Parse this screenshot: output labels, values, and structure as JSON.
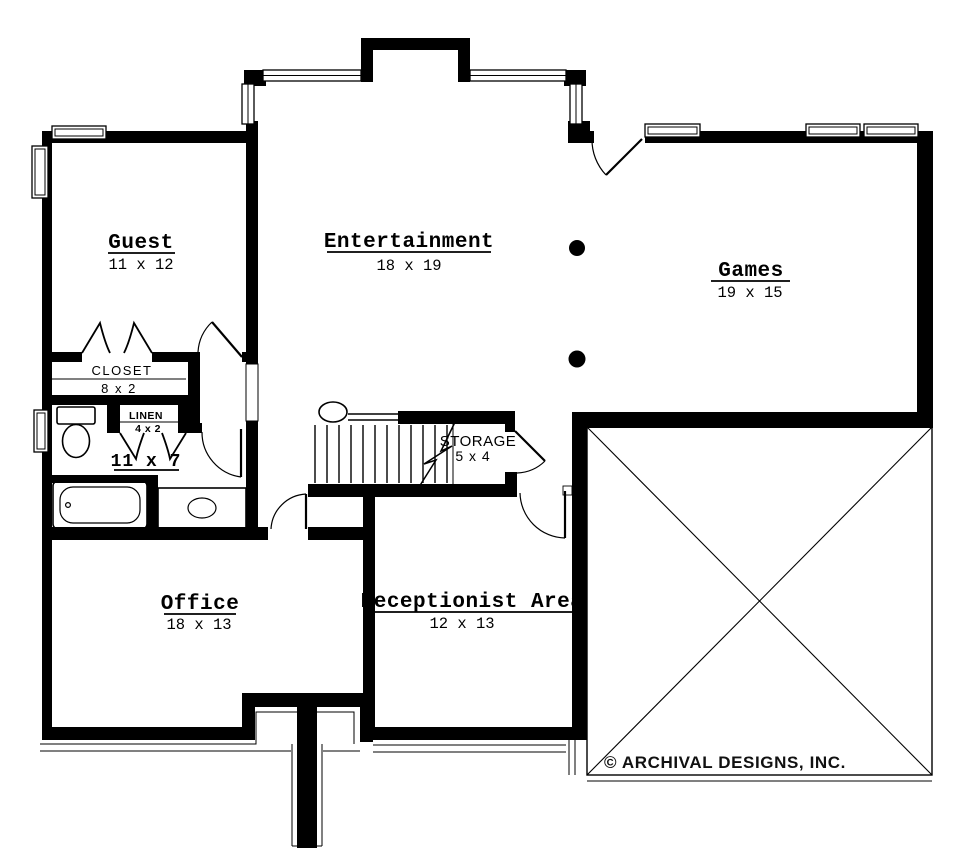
{
  "plan": {
    "title": "Basement Floor Plan",
    "rooms": {
      "guest": {
        "name": "Guest",
        "dims": "11 x 12"
      },
      "entertainment": {
        "name": "Entertainment",
        "dims": "18 x 19"
      },
      "games": {
        "name": "Games",
        "dims": "19 x 15"
      },
      "office": {
        "name": "Office",
        "dims": "18 x 13"
      },
      "receptionist": {
        "name": "Receptionist Area",
        "dims": "12 x 13"
      },
      "bath": {
        "dims": "11 x 7"
      },
      "closet": {
        "name": "CLOSET",
        "dims": "8 x 2"
      },
      "linen": {
        "name": "LINEN",
        "dims": "4 x 2"
      },
      "storage": {
        "name": "STORAGE",
        "dims": "5 x 4"
      }
    },
    "copyright": "© ARCHIVAL DESIGNS, INC.",
    "colors": {
      "ink": "#000000",
      "paper": "#ffffff"
    }
  }
}
